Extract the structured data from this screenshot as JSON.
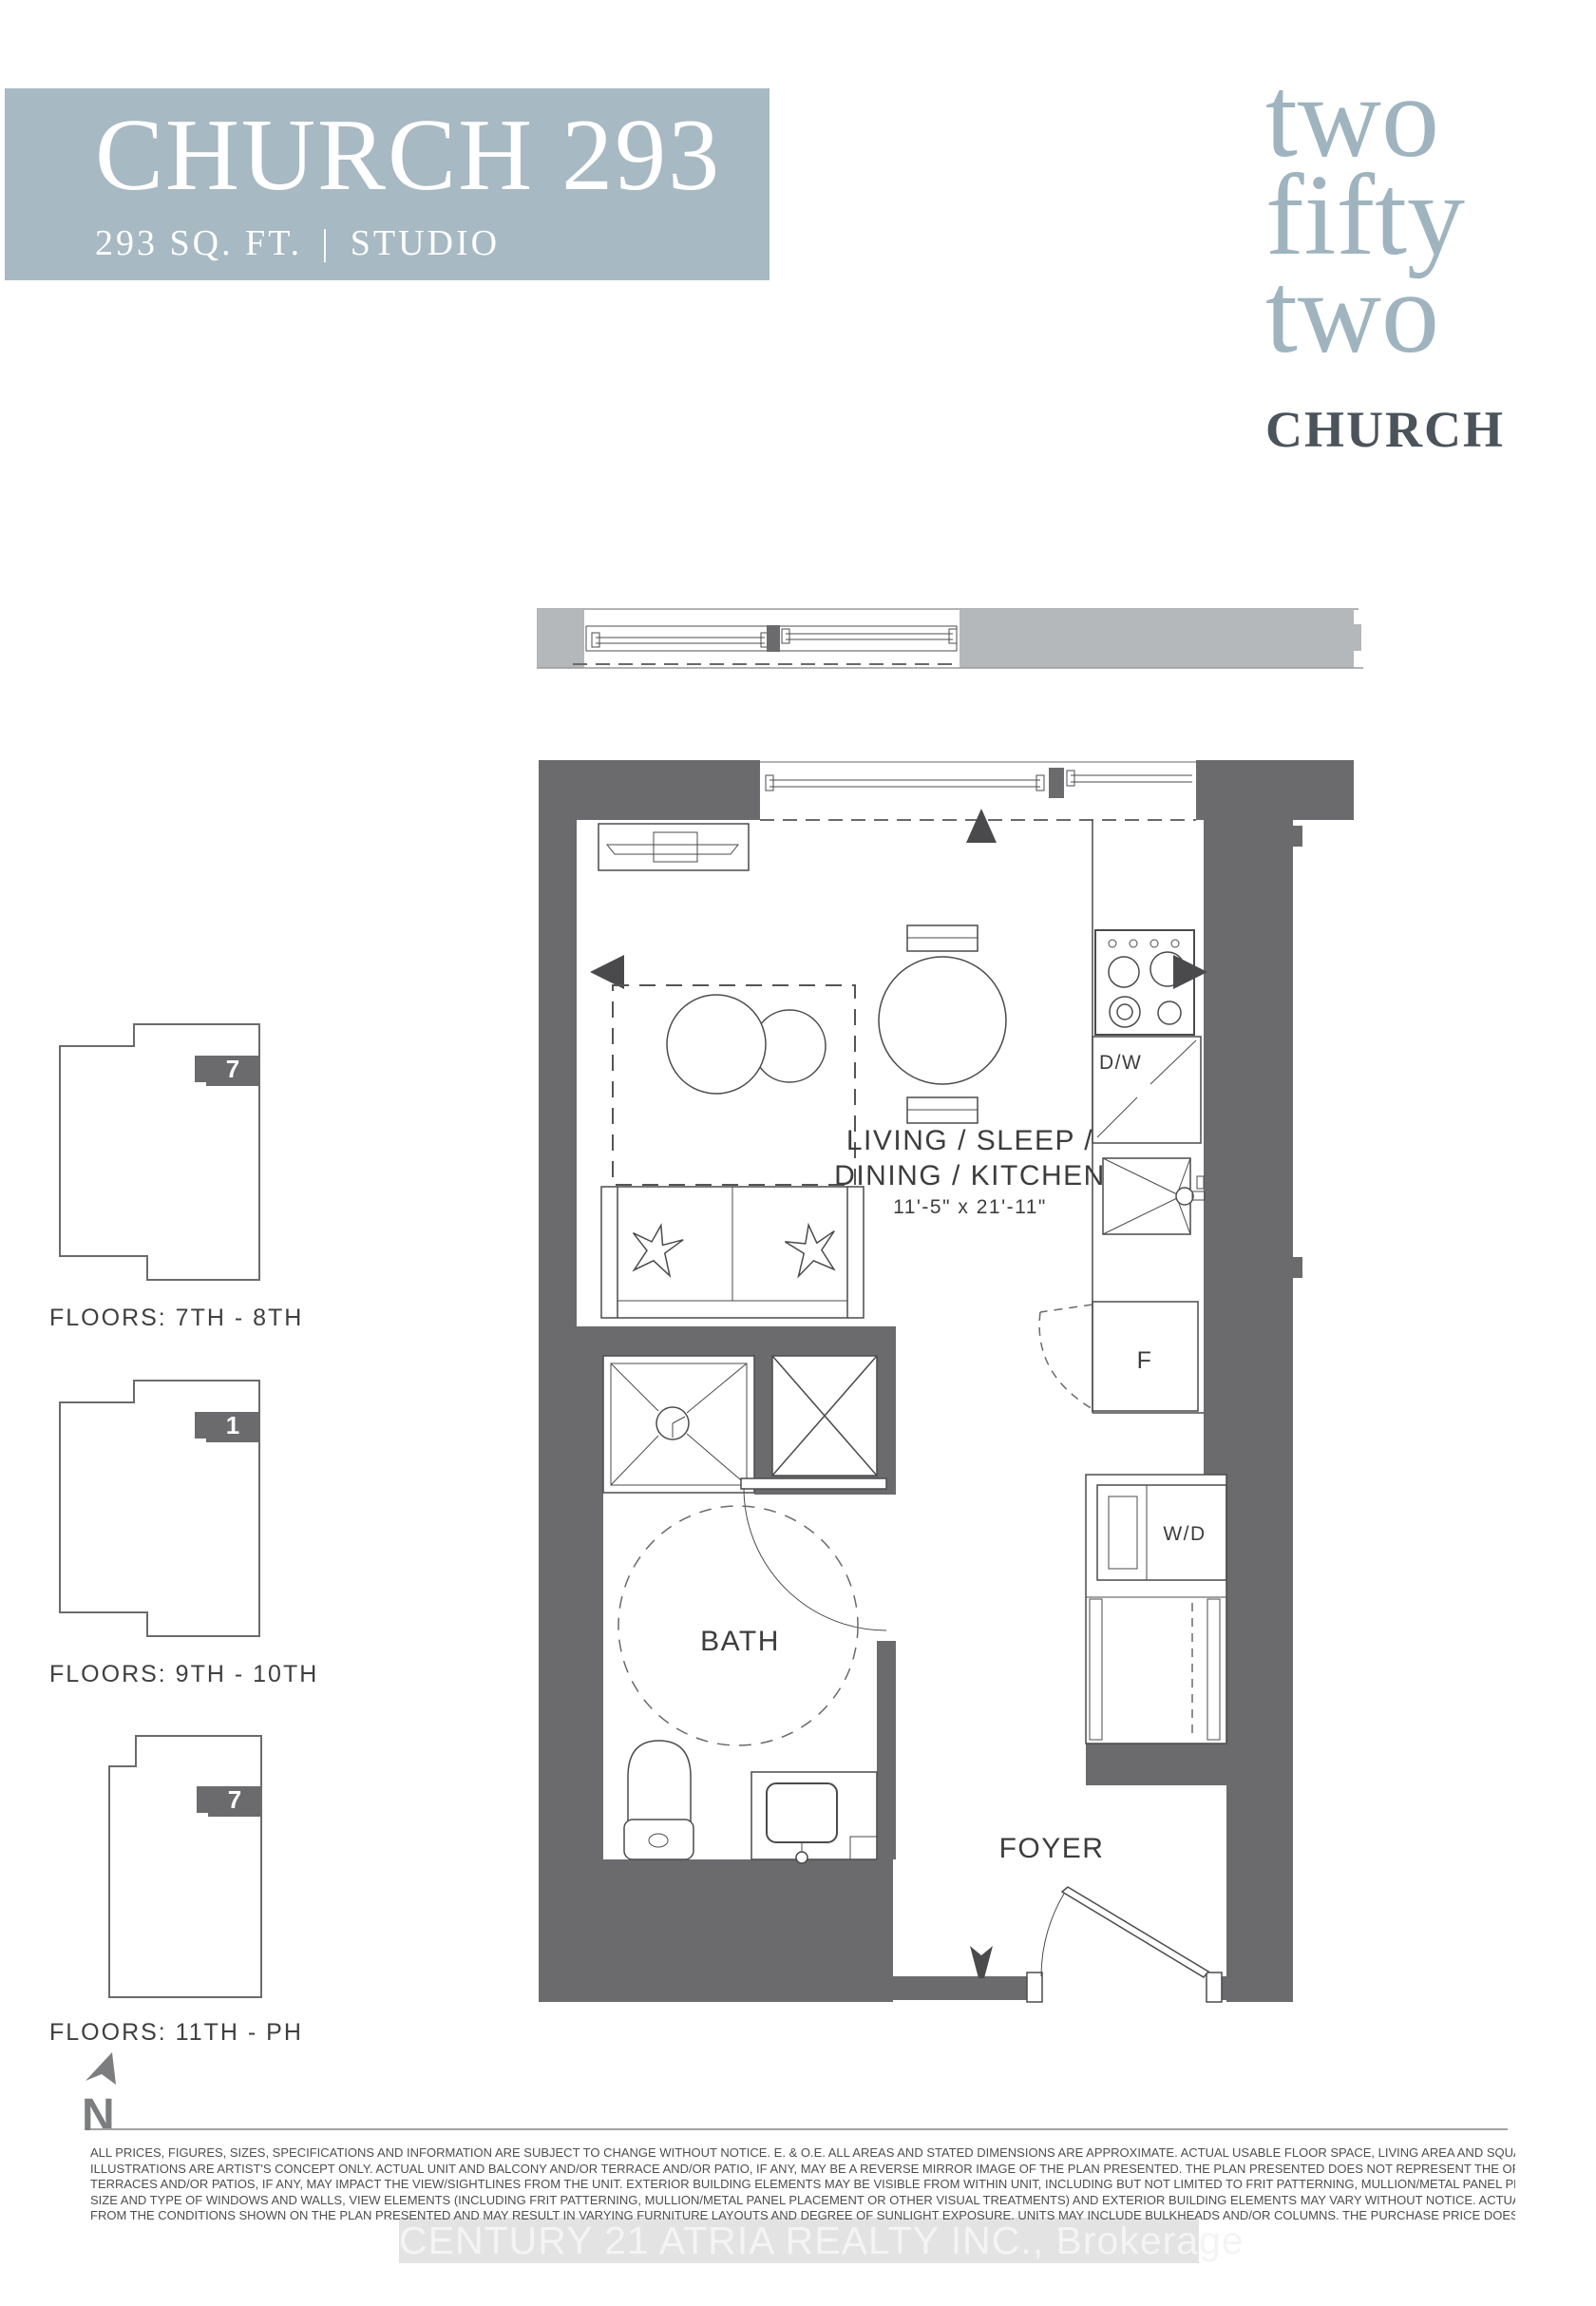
{
  "header": {
    "title": "CHURCH 293",
    "area": "293 SQ. FT.",
    "separator": "|",
    "unit_type": "STUDIO",
    "bg_color": "#a7b9c2"
  },
  "logo": {
    "word1": "two",
    "word2": "fifty",
    "word3": "two",
    "brand": "CHURCH",
    "accent_color": "#9fb4be",
    "brand_color": "#4b535b"
  },
  "floorplan": {
    "wall_color": "#6b6b6d",
    "balcony_color": "#b4b8bb",
    "line_color": "#4b4b4d",
    "labels": {
      "living_line1": "LIVING / SLEEP /",
      "living_line2": "DINING / KITCHEN",
      "living_dims": "11'-5\" x 21'-11\"",
      "bath": "BATH",
      "foyer": "FOYER",
      "dishwasher": "D/W",
      "fridge": "F",
      "washer_dryer": "W/D"
    }
  },
  "keyplans": [
    {
      "floors_label": "FLOORS: 7TH - 8TH",
      "unit_number": "7"
    },
    {
      "floors_label": "FLOORS: 9TH - 10TH",
      "unit_number": "1"
    },
    {
      "floors_label": "FLOORS: 11TH - PH",
      "unit_number": "7"
    }
  ],
  "compass": {
    "north_label": "N"
  },
  "disclaimer": {
    "lines": [
      "ALL PRICES, FIGURES, SIZES, SPECIFICATIONS AND INFORMATION ARE SUBJECT TO CHANGE WITHOUT NOTICE. E. & O.E. ALL AREAS AND STATED DIMENSIONS ARE APPROXIMATE. ACTUAL USABLE FLOOR SPACE, LIVING AREA AND SQUARE FOOTAGE MAY VARY FROM STATED FLOOR AREA. ALL",
      "ILLUSTRATIONS ARE ARTIST'S CONCEPT ONLY. ACTUAL UNIT AND BALCONY AND/OR TERRACE AND/OR PATIO, IF ANY, MAY BE A REVERSE MIRROR IMAGE OF THE PLAN PRESENTED. THE PLAN PRESENTED DOES NOT REPRESENT THE ORIENTATION OF THE ACTUAL UNIT. BALCONIES AND/OR",
      "TERRACES AND/OR PATIOS, IF ANY, MAY IMPACT THE VIEW/SIGHTLINES FROM THE UNIT. EXTERIOR BUILDING ELEMENTS MAY BE VISIBLE FROM WITHIN UNIT, INCLUDING BUT NOT LIMITED TO FRIT PATTERNING, MULLION/METAL PANEL PLACEMENTS, OR OTHER VISUAL TREATMENTS. THE LOCATION,",
      "SIZE AND TYPE OF WINDOWS AND WALLS, VIEW ELEMENTS (INCLUDING FRIT PATTERNING, MULLION/METAL PANEL PLACEMENT OR OTHER VISUAL TREATMENTS) AND EXTERIOR BUILDING ELEMENTS MAY VARY WITHOUT NOTICE. ACTUAL WINDOW AND WALL RATIOS FOR THE UNIT MAY DIFFER",
      "FROM THE CONDITIONS SHOWN ON THE PLAN PRESENTED AND MAY RESULT IN VARYING FURNITURE LAYOUTS AND DEGREE OF SUNLIGHT EXPOSURE. UNITS MAY INCLUDE BULKHEADS AND/OR COLUMNS. THE PURCHASE PRICE DOES NOT INCLUDE ANY FURNITURE. ALL RIGHTS RESERVED."
    ]
  },
  "watermark": {
    "text": "CENTURY 21 ATRIA REALTY INC., Brokerage"
  }
}
